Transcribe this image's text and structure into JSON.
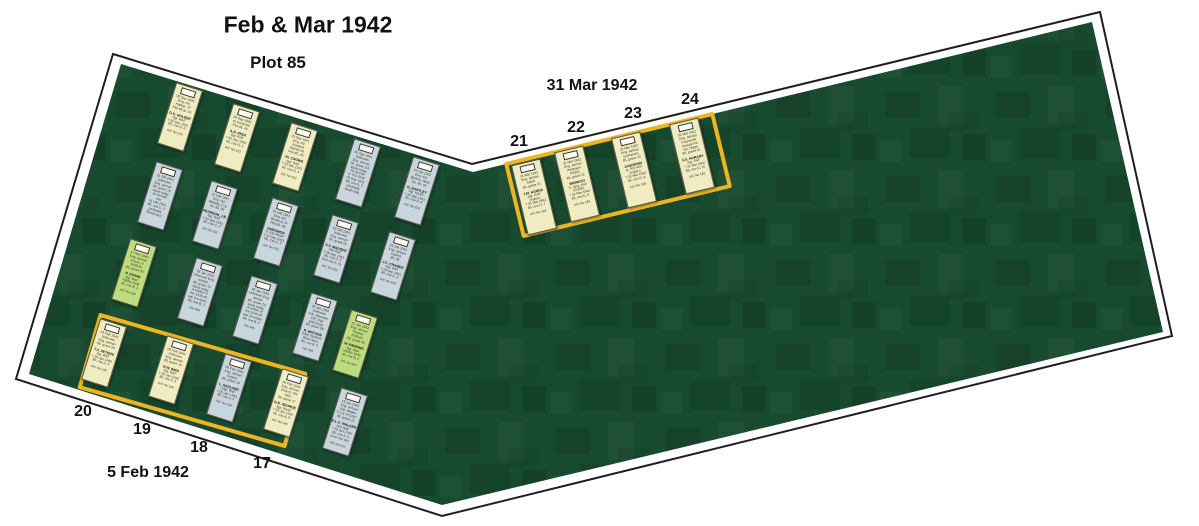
{
  "header": {
    "title": "Feb & Mar 1942",
    "subtitle": "Plot 85"
  },
  "captions": {
    "right_date": "31 Mar 1942",
    "left_date": "5 Feb 1942"
  },
  "colors": {
    "field": "#174a2e",
    "outline": "#1f1f1f",
    "box": "#eeb422",
    "cream": "#f0ecc2",
    "blue": "#c9d5dc",
    "green": "#bedc7d"
  },
  "grave_numbers": [
    {
      "text": "20",
      "x": 83,
      "y": 412
    },
    {
      "text": "19",
      "x": 142,
      "y": 430
    },
    {
      "text": "18",
      "x": 199,
      "y": 448
    },
    {
      "text": "17",
      "x": 262,
      "y": 464
    },
    {
      "text": "21",
      "x": 519,
      "y": 142
    },
    {
      "text": "22",
      "x": 576,
      "y": 128
    },
    {
      "text": "23",
      "x": 633,
      "y": 114
    },
    {
      "text": "24",
      "x": 690,
      "y": 100
    }
  ],
  "groups": [
    {
      "id": "left-box",
      "label": "5 Feb 1942",
      "x": 84,
      "y": 341,
      "w": 217,
      "h": 79,
      "rot": 16
    },
    {
      "id": "right-box",
      "label": "31 Mar 1942",
      "x": 510,
      "y": 136,
      "w": 216,
      "h": 78,
      "rot": -13.6
    }
  ],
  "markers": [
    {
      "id": "A1",
      "color": "cream",
      "cx": 180,
      "cy": 117,
      "rot": 17.5,
      "w": 28,
      "h": 64,
      "top": [
        "05 Sep 1940",
        "Eng. mil.",
        "Halifax, JT",
        "Plot 85 gr. 19"
      ],
      "name": "G.K. HOLDER",
      "details": [
        "Sgt. RAF",
        "† 02 Sep 1941",
        "85, row D, 2"
      ],
      "ref": "A/C No 152"
    },
    {
      "id": "A2",
      "color": "cream",
      "cx": 237,
      "cy": 138,
      "rot": 17.5,
      "w": 28,
      "h": 64,
      "top": [
        "05 Sep 1940",
        "no burial file",
        "Plot 85, 40"
      ],
      "name": "A.N. PEEK",
      "details": [
        "Sgt. RAF",
        "† 05 Sep 1940",
        "85, row D, 3"
      ],
      "ref": "A/C No 153"
    },
    {
      "id": "A3",
      "color": "cream",
      "cx": 295,
      "cy": 157,
      "rot": 17.5,
      "w": 28,
      "h": 64,
      "top": [
        "03 Sep 1941",
        "Eng. mil.",
        "bombed",
        "RAF84 40",
        "Plot 85, 49"
      ],
      "name": "JA. CROWE",
      "details": [
        "Sgt. RAF",
        "† 03 Sep 1941",
        "85, row D, 4"
      ],
      "ref": "A/C No 252"
    },
    {
      "id": "A4",
      "color": "blue",
      "cx": 358,
      "cy": 173,
      "rot": 17.5,
      "w": 28,
      "h": 64,
      "top": [
        "05 Sep 1941",
        "Unknown",
        "Eng. airman",
        "85, grave G4"
      ],
      "name": "",
      "details": [
        "stone today",
        "An Airman",
        "d. P/O RAF",
        "03 Sep 1941",
        "85, row D, 5",
        "(probably",
        "death link)"
      ],
      "ref": ""
    },
    {
      "id": "A5",
      "color": "blue",
      "cx": 417,
      "cy": 191,
      "rot": 17.5,
      "w": 28,
      "h": 64,
      "top": [
        "24 Okt 1942",
        "Eng. mil.",
        "Berline, Waal",
        "Vlo. 85, 09"
      ],
      "name": "G. BARTLEY",
      "details": [
        "Sgt. RAAF",
        "† 20 Sep 1941",
        "85, row D, 6"
      ],
      "ref": "A/C No 229"
    },
    {
      "id": "B1",
      "color": "blue",
      "cx": 160,
      "cy": 196,
      "rot": 17.5,
      "w": 28,
      "h": 64,
      "top": [
        "31 Okt 1941",
        "Unknown",
        "Eng. airman",
        "85, grave 10"
      ],
      "name": "",
      "details": [
        "stone today",
        "An Airman",
        "war",
        "31 Okt 1941",
        "85, row C, 2",
        "(probably",
        "Bondi two)"
      ],
      "ref": ""
    },
    {
      "id": "B2",
      "color": "blue",
      "cx": 215,
      "cy": 215,
      "rot": 17.5,
      "w": 28,
      "h": 64,
      "top": [
        "21 Okt 1941",
        "Eng. mil.",
        "Wallaby, C.E.",
        "vlo. 85, 09"
      ],
      "name": "PEARSON, J.E.",
      "details": [
        "Sgt. RAF",
        "† 20 Sep 1941",
        "85, row C, 3"
      ],
      "ref": "A/C No (D)"
    },
    {
      "id": "B3",
      "color": "blue",
      "cx": 276,
      "cy": 232,
      "rot": 17.5,
      "w": 28,
      "h": 64,
      "top": [
        "01 Okt 1941",
        "Eng. mil.",
        "Bentinck, R",
        "Plot 85, 08"
      ],
      "name": "DUROMON",
      "details": [
        "d. 232 RCAF",
        "† 03 Sep 1941",
        "85, row C, 4"
      ],
      "ref": "A/C No 232"
    },
    {
      "id": "B4",
      "color": "blue",
      "cx": 336,
      "cy": 249,
      "rot": 17.5,
      "w": 28,
      "h": 64,
      "top": [
        "03 Okt 1941",
        "Unknown",
        "Eng. airman",
        "85, grave 09"
      ],
      "name": "C.F. MADSEN",
      "details": [
        "232 RAF",
        "† 06 Sep 1941",
        "85, row C, 5",
        "(but row A, 9)"
      ],
      "ref": "A/C No 232"
    },
    {
      "id": "B5",
      "color": "blue",
      "cx": 393,
      "cy": 266,
      "rot": 17.5,
      "w": 28,
      "h": 64,
      "top": [
        "24 Okt 1941",
        "Eng. airman",
        "Galtres",
        "85, 06"
      ],
      "name": "J.C. CRAMER",
      "details": [
        "Sgt. RAF",
        "† 09 Sep 1941",
        "85, row C, 6"
      ],
      "ref": "A/C No 229"
    },
    {
      "id": "C1",
      "color": "green",
      "cx": 134,
      "cy": 273,
      "rot": 17.5,
      "w": 28,
      "h": 64,
      "top": [
        "17 Nov 1940",
        "Eng. airman",
        "Evans, vl",
        "1902/10",
        "85, grave 42"
      ],
      "name": "N. EVANS",
      "details": [
        "Sgt. RAF",
        "Halifax bwlk",
        "85, row B, 2"
      ],
      "ref": "A/C No 159"
    },
    {
      "id": "C2",
      "color": "blue",
      "cx": 200,
      "cy": 292,
      "rot": 17.5,
      "w": 28,
      "h": 64,
      "top": [
        "05 Jan 1942",
        "Unknown Eng.",
        "airman",
        "85, grave 43"
      ],
      "name": "",
      "details": [
        "stone today",
        "A soldier of",
        "the 1939-45",
        "war (no date)",
        "85, row B, 3"
      ],
      "ref": "File 948"
    },
    {
      "id": "C3",
      "color": "blue",
      "cx": 255,
      "cy": 310,
      "rot": 17.5,
      "w": 28,
      "h": 64,
      "top": [
        "05 Jan 1942",
        "Unknown Eng.",
        "airman",
        "85, grave C2"
      ],
      "name": "",
      "details": [
        "stone today",
        "A soldier of",
        "the 1939-45",
        "war (no date)",
        "85, row B, 4"
      ],
      "ref": "File 940"
    },
    {
      "id": "C4",
      "color": "blue",
      "cx": 315,
      "cy": 327,
      "rot": 17.5,
      "w": 28,
      "h": 64,
      "top": [
        "05 Jan 1942",
        "Unknown",
        "H.B. Wayman",
        "V.R. Oak",
        "k/527/158",
        "85, grave 58"
      ],
      "name": "N. MATSON",
      "details": [
        "Kilan Spanish",
        "Ritari diary",
        "85, row B, 5"
      ],
      "ref": "File 948"
    },
    {
      "id": "C5",
      "color": "green",
      "cx": 355,
      "cy": 344,
      "rot": 17.5,
      "w": 28,
      "h": 64,
      "top": [
        "01 Jan 1942",
        "Eng. airman",
        "Parsloe",
        "K92020",
        "85, grave 59"
      ],
      "name": "W. PARDING",
      "details": [
        "Sgt. RAF",
        "Halifax 1945",
        "85, row B, 6"
      ],
      "ref": "A/C No 194"
    },
    {
      "id": "D1",
      "color": "cream",
      "cx": 104,
      "cy": 353,
      "rot": 17.5,
      "w": 28,
      "h": 64,
      "top": [
        "05 Feb 1942",
        "Unknown",
        "Eng. airman",
        "85, grave 20"
      ],
      "name": "T.A. PETERS",
      "details": [
        "Sgt. RAF",
        "† 05 Jan 1942",
        "85, row A, 2"
      ],
      "ref": "A/C No 146"
    },
    {
      "id": "D2",
      "color": "cream",
      "cx": 171,
      "cy": 370,
      "rot": 17.5,
      "w": 28,
      "h": 64,
      "top": [
        "05 Feb 1942",
        "Unknown",
        "Eng. airman",
        "85, grave 19"
      ],
      "name": "R.W. BIRD",
      "details": [
        "Sgt. RAF",
        "† 05 Jan 1942",
        "85, row A, 3"
      ],
      "ref": "A/C No 146"
    },
    {
      "id": "D3",
      "color": "blue",
      "cx": 229,
      "cy": 388,
      "rot": 17.5,
      "w": 28,
      "h": 64,
      "top": [
        "05 Feb 1942",
        "Eng. airman",
        "Sagard",
        "85, grave 18"
      ],
      "name": "L. SADLAND",
      "details": [
        "Cdgt. RNF",
        "† 05 Jan 1942",
        "85, row A, 4"
      ],
      "ref": "A/C No 218"
    },
    {
      "id": "D4",
      "color": "cream",
      "cx": 286,
      "cy": 403,
      "rot": 17.5,
      "w": 28,
      "h": 64,
      "top": [
        "05 Feb 1942",
        "Eng. airman",
        "Church, DN",
        "b/lot",
        "85, grave 17"
      ],
      "name": "G.N. GEORGE",
      "details": [
        "Sgt. RAAF",
        "† 05 Jan 1942",
        "85, row A, 5"
      ],
      "ref": "A/C No 146"
    },
    {
      "id": "D5",
      "color": "blue",
      "cx": 345,
      "cy": 422,
      "rot": 17.5,
      "w": 28,
      "h": 64,
      "top": [
        "15 Jun 1942",
        "Eng. airman",
        "Sgt. Walker",
        "C.L.E 97/1067",
        "85, grave 16"
      ],
      "name": "E.L.C. WALKER",
      "details": [
        "P/O RAF",
        "† 22 Jun 1942",
        "85, row A, 6",
        "(rest one de)"
      ],
      "ref": "A/C No 227"
    },
    {
      "id": "T21",
      "color": "cream",
      "cx": 534,
      "cy": 197,
      "rot": -13.5,
      "w": 30,
      "h": 72,
      "top": [
        "31 Mar 1942",
        "Eng. airman",
        "Jakob",
        "85, grave 21"
      ],
      "name": "J.M. KORDA",
      "details": [
        "Sgt. RAF",
        "(Polish)",
        "† 31 Mar 1942",
        "85, row D, 7"
      ],
      "ref": "A/C No 126"
    },
    {
      "id": "T22",
      "color": "cream",
      "cx": 577,
      "cy": 184,
      "rot": -13.5,
      "w": 30,
      "h": 72,
      "top": [
        "31 Mar 1942",
        "Eng. airman",
        "Harlequin",
        "P9306",
        "85, grave 22"
      ],
      "name": "WINNICKI",
      "details": [
        "S. Serg. PAF",
        "(Polish)",
        "† 31 Mar 1942",
        "85, row D, 8"
      ],
      "ref": "A/C No 126"
    },
    {
      "id": "T23",
      "color": "cream",
      "cx": 634,
      "cy": 170,
      "rot": -13.5,
      "w": 30,
      "h": 72,
      "top": [
        "31 Mar 1942",
        "Eng. airman",
        "(unknown)",
        "85, grave 23"
      ],
      "name": "JANOWSKI",
      "details": [
        "st. P/O PAF",
        "(Polish)",
        "† 31 Mar 1942",
        "85, row D, 9"
      ],
      "ref": "A/C No 126"
    },
    {
      "id": "T24",
      "color": "cream",
      "cx": 692,
      "cy": 156,
      "rot": -13.5,
      "w": 30,
      "h": 72,
      "top": [
        "31 Mar 1942",
        "Eng. airman",
        "Przewoski",
        "Parade Rd",
        "RC 78396",
        "85, grave 24"
      ],
      "name": "F.S. HORADA",
      "details": [
        "Sgt. PAF",
        "† 31 Mar 1942",
        "85, row D, 10"
      ],
      "ref": "A/C No 126"
    }
  ]
}
